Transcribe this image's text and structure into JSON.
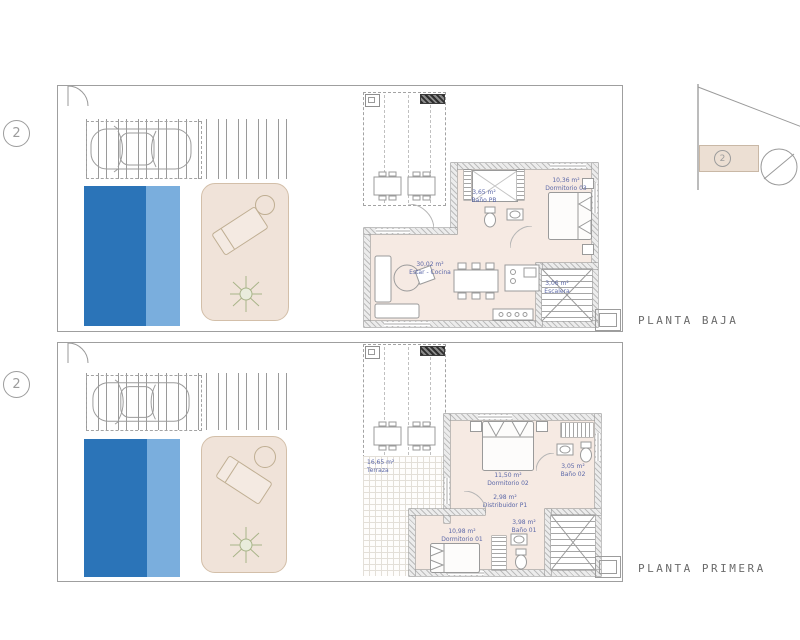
{
  "document": {
    "type": "architectural floor plan",
    "background": "#ffffff"
  },
  "colors": {
    "pool_dark": "#2b74b8",
    "pool_light": "#7aaedd",
    "terrace_fill": "#f0e3d9",
    "floor_fill": "#f6eae3",
    "label_blue": "#5c68a8",
    "line_gray": "#9a9a9a"
  },
  "key_plan": {
    "unit": "2"
  },
  "plans": [
    {
      "title": "PLANTA BAJA",
      "marker": "2",
      "rooms": {
        "bano": {
          "area": "3,65 m²",
          "name": "Baño PB"
        },
        "dormitorio": {
          "area": "10,36 m²",
          "name": "Dormitorio 03"
        },
        "estar": {
          "area": "30,02 m²",
          "name": "Estar - Cocina"
        },
        "escalera": {
          "area": "3,06 m²",
          "name": "Escalera"
        }
      }
    },
    {
      "title": "PLANTA PRIMERA",
      "marker": "2",
      "rooms": {
        "terraza": {
          "area": "16,65 m²",
          "name": "Terraza"
        },
        "dormitorio2": {
          "area": "11,50 m²",
          "name": "Dormitorio 02"
        },
        "bano2": {
          "area": "3,05 m²",
          "name": "Baño 02"
        },
        "distribuidor": {
          "area": "2,98 m²",
          "name": "Distribuidor P1"
        },
        "dormitorio1": {
          "area": "10,98 m²",
          "name": "Dormitorio 01"
        },
        "bano1": {
          "area": "3,98 m²",
          "name": "Baño 01"
        }
      }
    }
  ]
}
